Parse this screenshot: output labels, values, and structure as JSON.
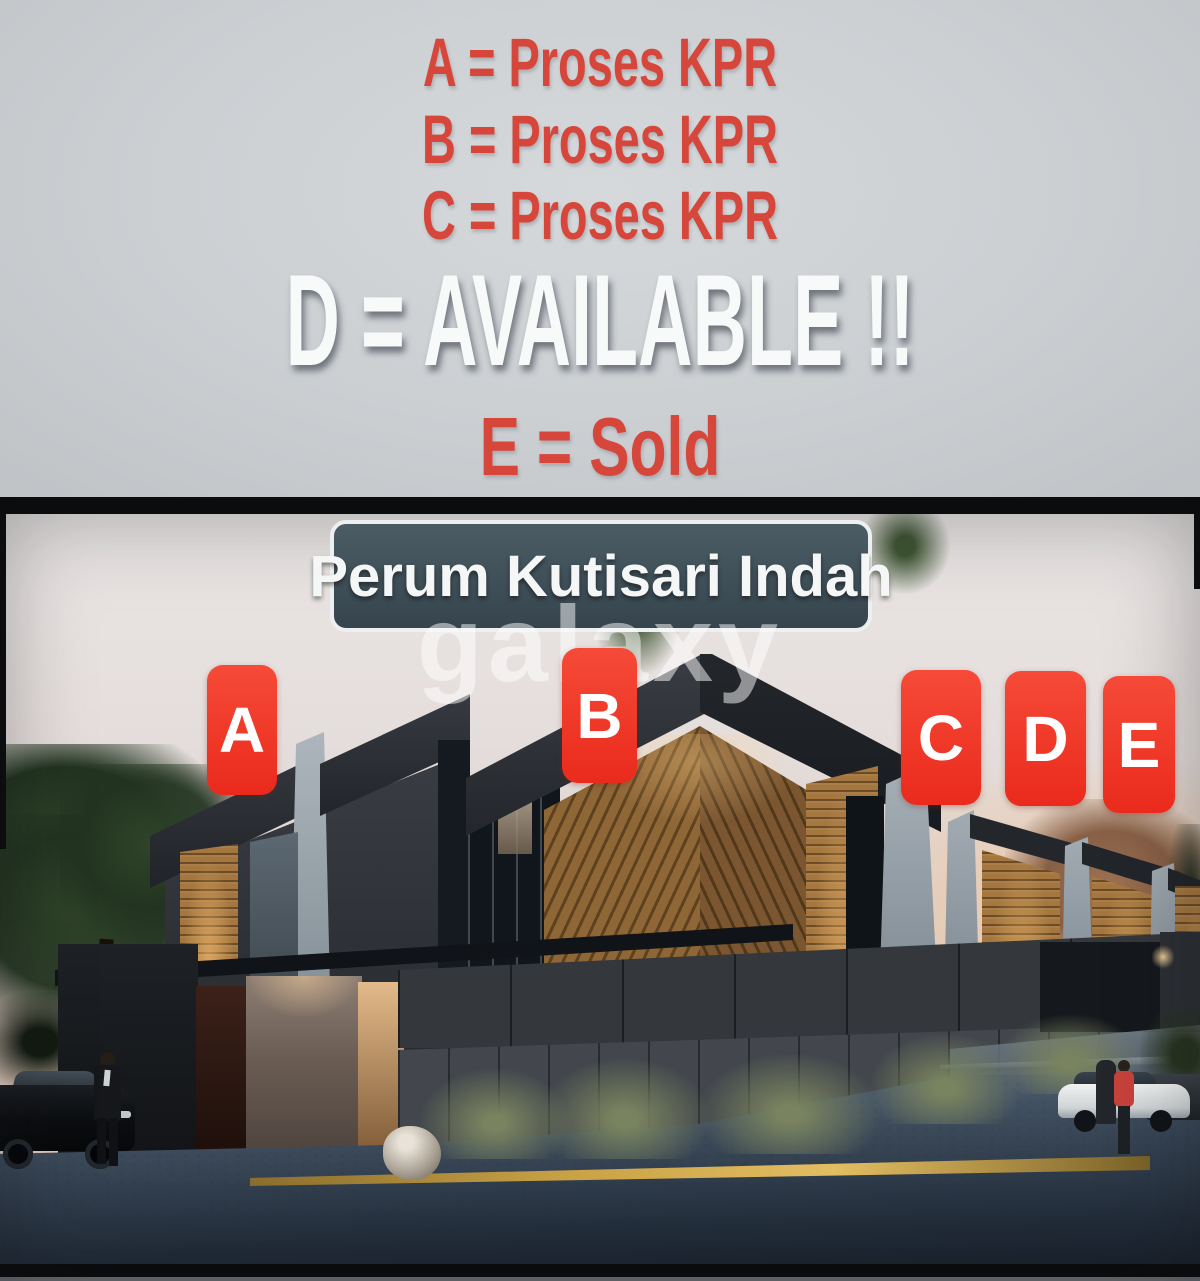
{
  "legend": {
    "lines": [
      {
        "text": "A = Proses KPR",
        "status_color": "#d7463a"
      },
      {
        "text": "B = Proses KPR",
        "status_color": "#d7463a"
      },
      {
        "text": "C = Proses KPR",
        "status_color": "#d7463a"
      },
      {
        "text": "D = AVAILABLE !!",
        "status_color": "#f8f9f9"
      },
      {
        "text": "E = Sold",
        "status_color": "#d7463a"
      }
    ]
  },
  "photo": {
    "badge_text": "Perum Kutisari Indah",
    "watermark_text": "galaxy",
    "unit_labels": [
      {
        "letter": "A"
      },
      {
        "letter": "B"
      },
      {
        "letter": "C"
      },
      {
        "letter": "D"
      },
      {
        "letter": "E"
      }
    ]
  },
  "colors": {
    "legend_red": "#d7463a",
    "available_white": "#f8f9f9",
    "unit_label_red": "#ee3124",
    "badge_background": "#41525b",
    "badge_border": "#edeff0",
    "divider_black": "#0b0c0d"
  }
}
